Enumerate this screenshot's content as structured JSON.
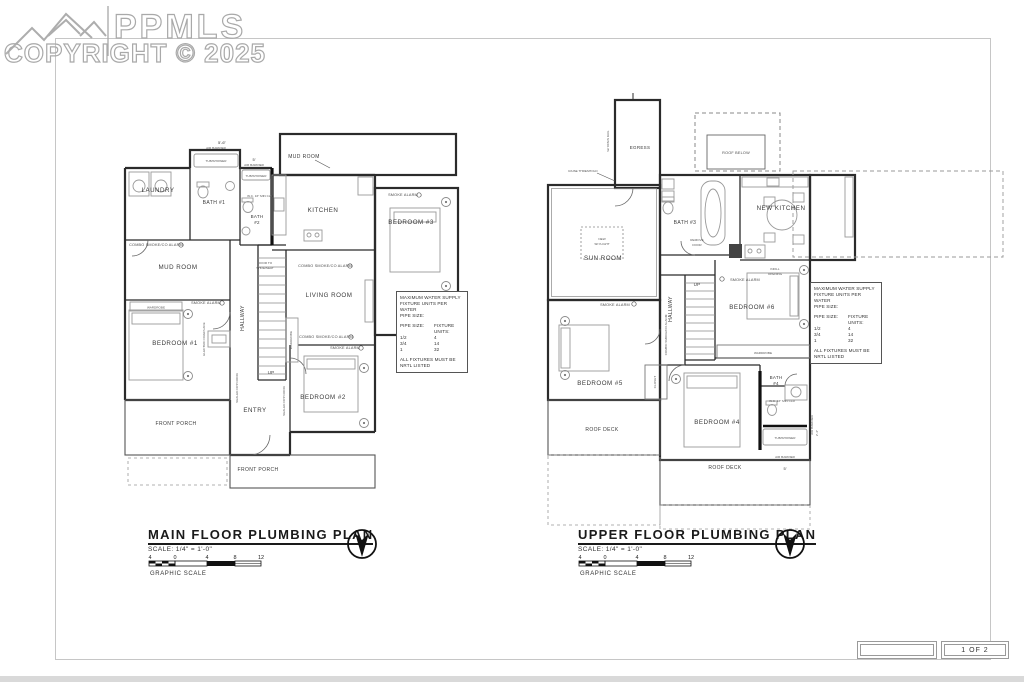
{
  "watermark": {
    "brand": "PPMLS",
    "copyright": "COPYRIGHT © 2025"
  },
  "sheet": {
    "page_label": "1 OF 2"
  },
  "note_box": {
    "line1": "MAXIMUM WATER SUPPLY",
    "line2": "FIXTURE UNITS PER WATER",
    "line3": "PIPE SIZE:",
    "col_pipe": "PIPE SIZE:",
    "col_units": "FIXTURE UNITS:",
    "rows": [
      [
        "1/2",
        "4"
      ],
      [
        "3/4",
        "14"
      ],
      [
        "1",
        "32"
      ]
    ],
    "footer1": "ALL FIXTURES MUST BE",
    "footer2": "NRTL LISTED"
  },
  "main_plan": {
    "title": "MAIN FLOOR PLUMBING PLAN",
    "scale_note": "SCALE: 1/4\" = 1'-0\"",
    "graphic_scale_label": "GRAPHIC SCALE",
    "ticks": [
      "4",
      "0",
      "4",
      "8",
      "12"
    ],
    "rooms": {
      "laundry": "LAUNDRY",
      "bath1": "BATH #1",
      "bath2_l1": "BATH",
      "bath2_l2": "#2",
      "mud_top": "MUD ROOM",
      "kitchen": "KITCHEN",
      "mud": "MUD ROOM",
      "living": "LIVING ROOM",
      "bedroom1": "BEDROOM #1",
      "hallway": "HALLWAY",
      "bedroom3": "BEDROOM #3",
      "entry": "ENTRY",
      "bedroom2": "BEDROOM #2",
      "porch_left": "FRONT PORCH",
      "porch_bottom": "FRONT PORCH",
      "up": "UP"
    },
    "ann": {
      "air_barrier": "AIR BARRIER",
      "tub_shower": "TUB/SHOWER",
      "combo_alarm": "COMBO SMOKE/CO ALARM",
      "smoke_alarm": "SMOKE ALARM",
      "wardrobe": "WARDROBE",
      "fireplace": "ELECTRIC FIREPLACE",
      "door_shoe_l1": "DOOR TO",
      "door_shoe_l2": "SHOE/SEAT",
      "sealed_door": "SEALED OPP DOOR",
      "dim_bath1": "5'-6\"",
      "dim_bath2": "5'",
      "wc": "W.C. 16\" MIN CLR"
    }
  },
  "upper_plan": {
    "title": "UPPER FLOOR PLUMBING PLAN",
    "scale_note": "SCALE: 1/4\" = 1'-0\"",
    "graphic_scale_label": "GRAPHIC SCALE",
    "ticks": [
      "4",
      "0",
      "4",
      "8",
      "12"
    ],
    "rooms": {
      "sun": "SUN ROOM",
      "egress": "EGRESS",
      "bath3": "BATH #3",
      "kitchen": "NEW KITCHEN",
      "roof_below": "ROOF BELOW",
      "hallway": "HALLWAY",
      "bedroom5": "BEDROOM #5",
      "bedroom6": "BEDROOM #6",
      "bedroom4": "BEDROOM #4",
      "bath4_l1": "BATH",
      "bath4_l2": "#4",
      "deck_left": "ROOF DECK",
      "deck_bottom": "ROOF DECK",
      "up": "UP",
      "closet": "CLOSET",
      "wardrobe": "WARDROBE"
    },
    "ann": {
      "open_rail": "W/ OPEN RAIL",
      "raise_threshold": "RAISE THRESHOLD",
      "skylight_l1": "NEW",
      "skylight_l2": "SKYLIGHT",
      "remove_l1": "REMOVE",
      "remove_l2": "DOOR",
      "infill_l1": "INFILL",
      "infill_l2": "OPENING",
      "smoke_alarm": "SMOKE ALARM",
      "combo_alarm": "COMBO SMOKE/CO ALARM",
      "tub_shower": "TUB/SHOWER",
      "air_barrier": "AIR BARRIER",
      "dim_5": "5'",
      "dim_24": "2'-4\"",
      "wc": "W.C. 16\" MIN CLR"
    }
  }
}
